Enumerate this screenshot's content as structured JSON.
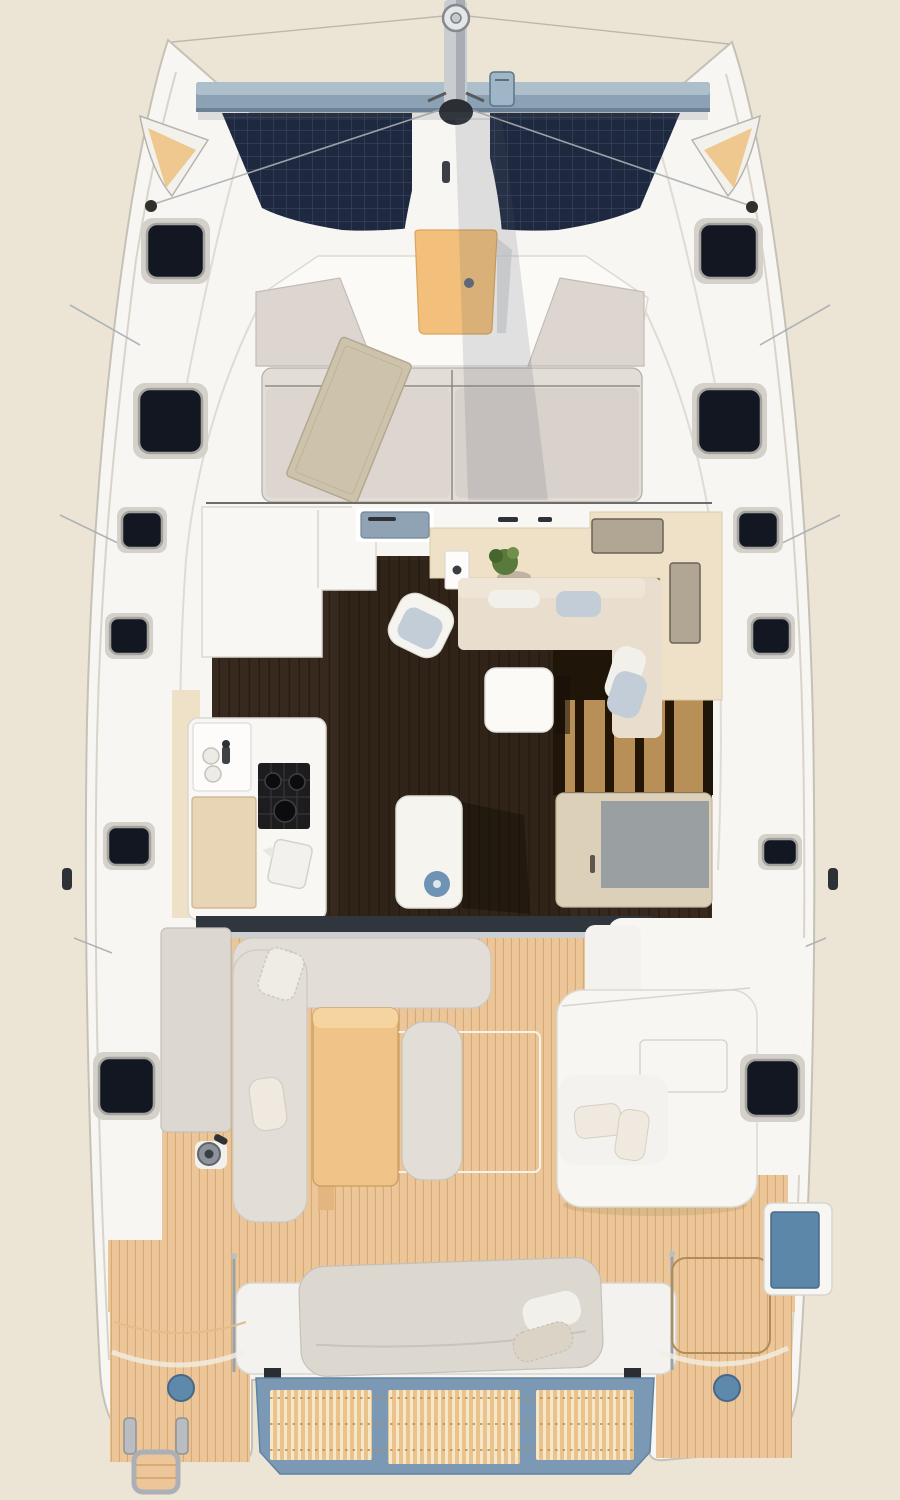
{
  "scene": {
    "subject": "catamaran-deck-plan-top-view"
  },
  "colors": {
    "background": "#ece5d6",
    "hull_white": "#f7f6f3",
    "deck_shade": "#ededea",
    "beam_blue": "#8ca1b4",
    "beam_light": "#aebfcc",
    "mast_metal": "#c9cdd0",
    "mast_dark": "#2b2f35",
    "solar_dark": "#1e2940",
    "solar_grid": "#35415c",
    "bow_seat_tan": "#eec88e",
    "bow_trim": "#f2f1ec",
    "hatch_dark": "#121722",
    "hatch_recess": "#d4d1ca",
    "fwd_bench_white": "#fbfaf7",
    "wing_gray": "#ddd6d0",
    "fwd_table_tan": "#f2c07a",
    "roof_top": "#e3ddd7",
    "roof_panel": "#ddd6d0",
    "roof_panel_dark": "#d9d2cc",
    "rug": "#cdc2ab",
    "floor_dark": "#37291d",
    "floor_line": "#2a1e14",
    "stair_dark": "#201509",
    "stair_wood": "#b98f58",
    "galley_white": "#f8f7f4",
    "counter_tan": "#efe1c8",
    "counter_hatch": "#b1a593",
    "sink_blue": "#8fa3b4",
    "sofa_beige": "#e9decd",
    "sofa_light": "#efe5d6",
    "pillow_white": "#f2f0ea",
    "pillow_blue": "#c3cdd8",
    "table_white": "#fbfaf7",
    "island_white": "#f6f4ef",
    "bowl_blue": "#6f93b5",
    "stove_black": "#1d1d1f",
    "burner_dark": "#0c0c0e",
    "board_tan": "#e8d5b5",
    "cabinet_beige": "#ddd0b9",
    "cabinet_gray": "#9aa0a2",
    "threshold_dark": "#30363e",
    "threshold_light": "#ccd0d2",
    "teak": "#ecc698",
    "teak_line": "#d7ab74",
    "console_gray": "#dcd7d1",
    "cockpit_sofa": "#e2ddd6",
    "table_wood": "#f0c488",
    "table_wood_light": "#f6d4a0",
    "cushion_cream": "#efe9df",
    "winch_gray": "#8d939a",
    "bench_white": "#f4f2ee",
    "sunbed_gray": "#dcd8d0",
    "platform_blue": "#7b99b4",
    "slat_cream": "#f5e7c9",
    "slat_tan": "#eac28c",
    "hatch_blue": "#5e89ab",
    "liferaft_blue": "#5d87a8",
    "rig_gray": "#9aa1a8",
    "shadow_tone": "#54606c"
  }
}
